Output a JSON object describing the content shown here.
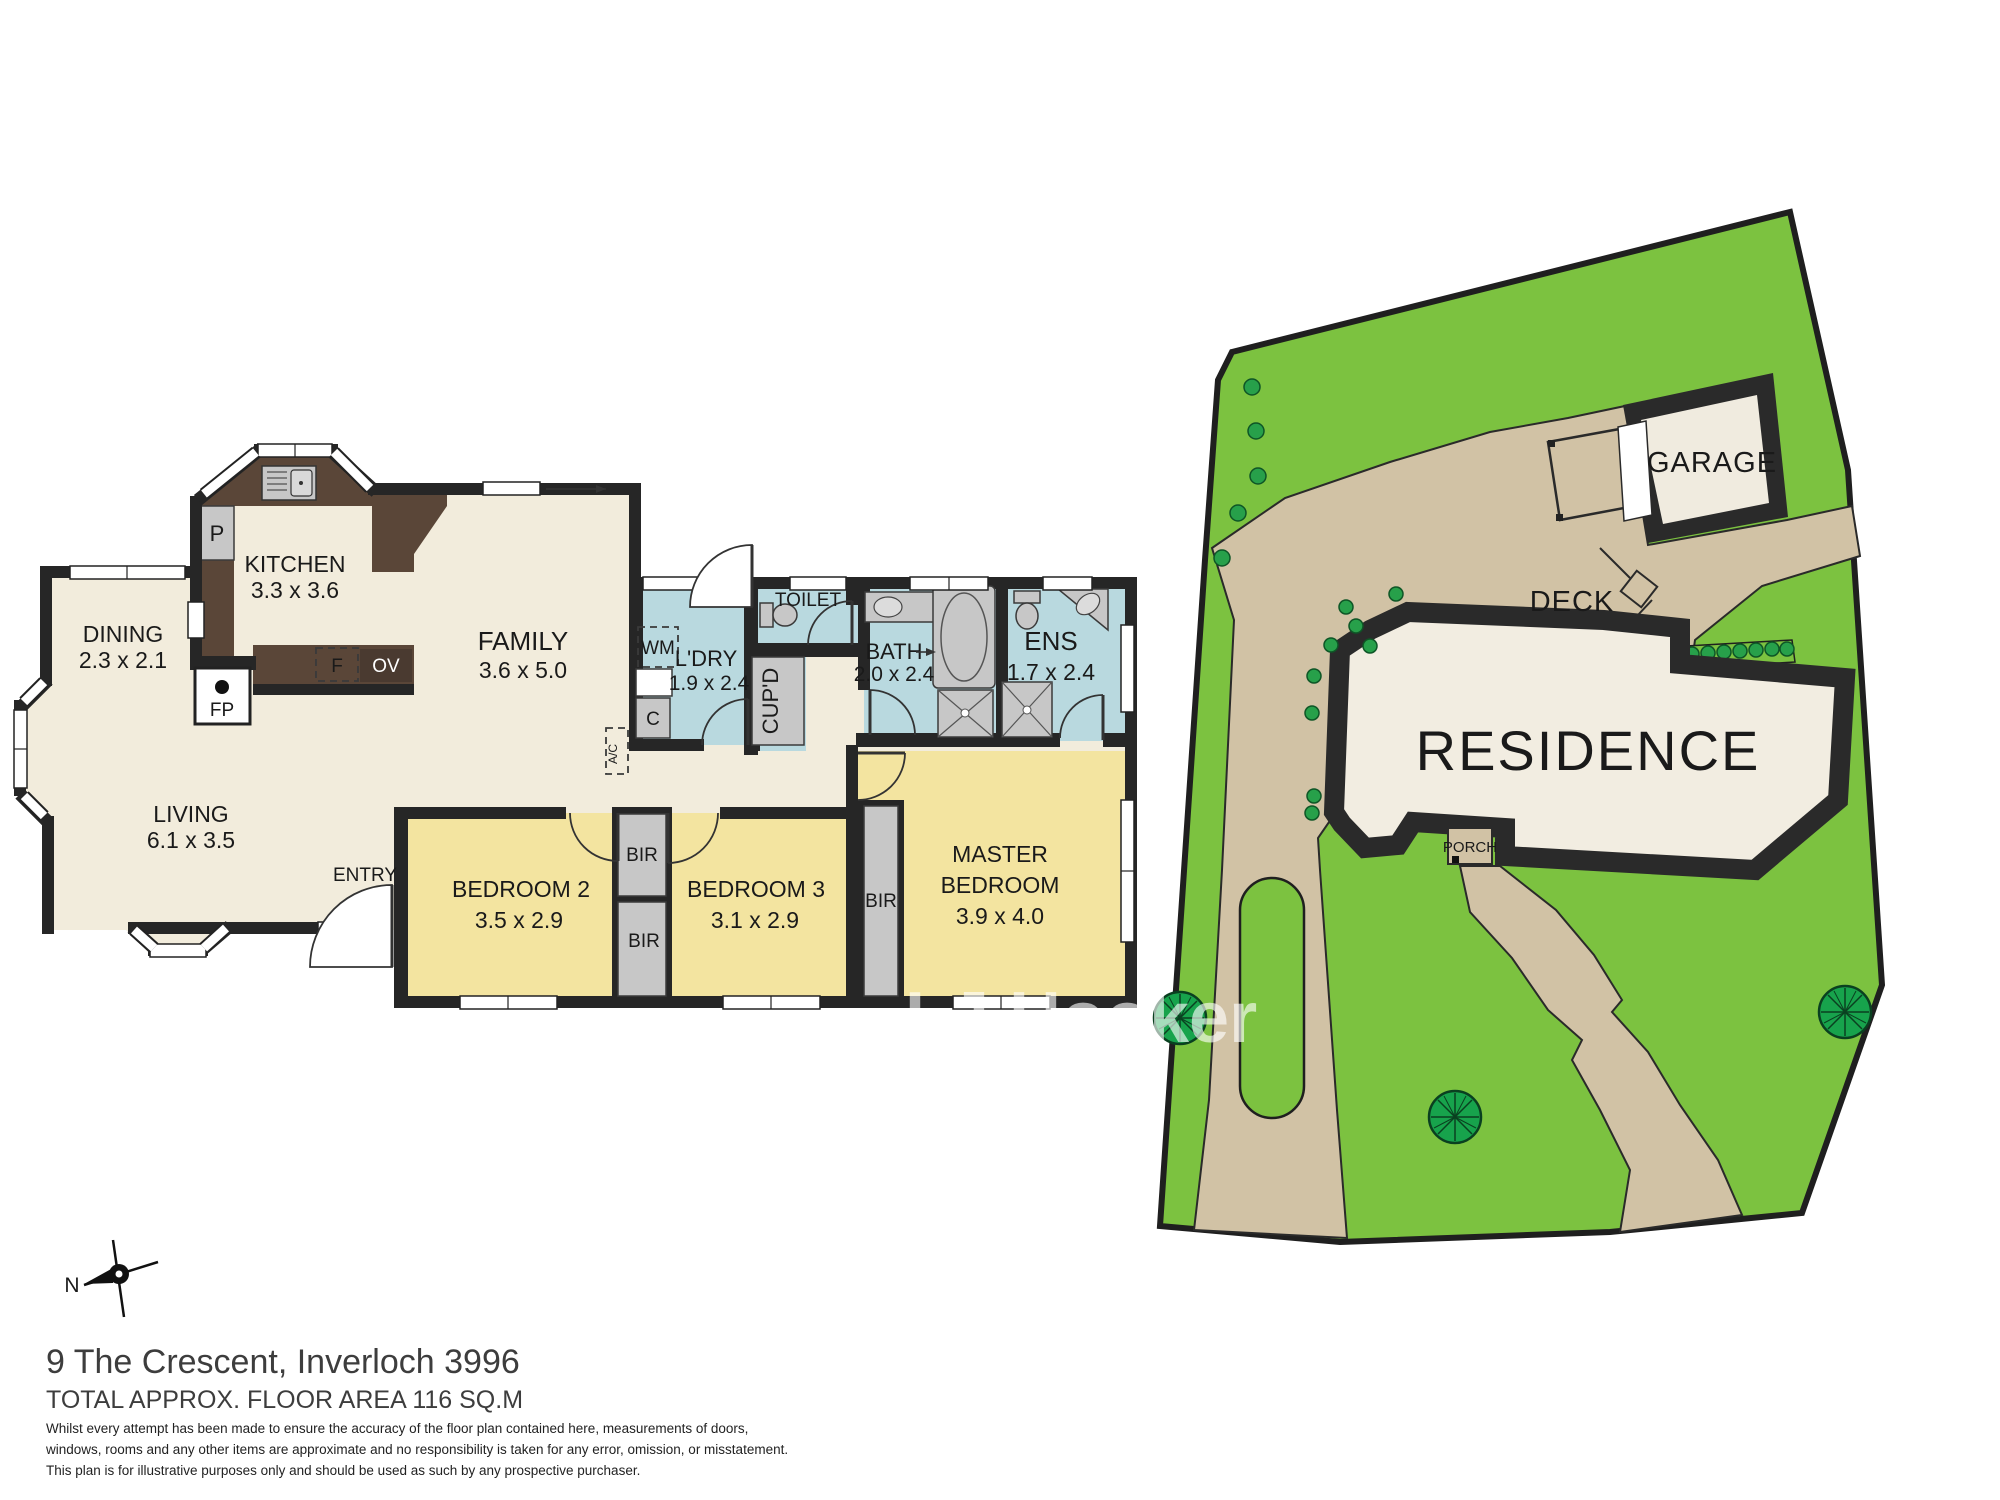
{
  "colors": {
    "wall": "#262626",
    "floor_beige": "#f2ecdc",
    "bedroom_yellow": "#f3e4a0",
    "wet_blue": "#b9d9df",
    "counter_brown": "#5a4638",
    "fixture_grey": "#c7c7c7",
    "site_green": "#7cc240",
    "paving_tan": "#d1c2a5",
    "tree_green": "#17a34c",
    "residence_cream": "#f2ede1"
  },
  "floor": {
    "rooms": {
      "dining": {
        "name": "DINING",
        "dims": "2.3 x 2.1"
      },
      "kitchen": {
        "name": "KITCHEN",
        "dims": "3.3 x 3.6"
      },
      "family": {
        "name": "FAMILY",
        "dims": "3.6 x 5.0"
      },
      "living": {
        "name": "LIVING",
        "dims": "6.1 x 3.5"
      },
      "entry": {
        "name": "ENTRY"
      },
      "bed2": {
        "name": "BEDROOM 2",
        "dims": "3.5 x 2.9"
      },
      "bed3": {
        "name": "BEDROOM 3",
        "dims": "3.1 x 2.9"
      },
      "master": {
        "l1": "MASTER",
        "l2": "BEDROOM",
        "dims": "3.9 x 4.0"
      },
      "ldry": {
        "name": "L'DRY",
        "dims": "1.9 x 2.4"
      },
      "bath": {
        "name": "BATH",
        "dims": "2.0 x 2.4"
      },
      "ens": {
        "name": "ENS",
        "dims": "1.7 x 2.4"
      },
      "toilet": {
        "name": "TOILET"
      }
    },
    "fixtures": {
      "pantry": "P",
      "fridge": "F",
      "oven": "OV",
      "fireplace": "FP",
      "washer": "WM",
      "trough": "C",
      "aircon": "A/C",
      "cupboard": "CUP'D",
      "robe": "BIR"
    }
  },
  "site": {
    "residence": "RESIDENCE",
    "deck": "DECK",
    "garage": "GARAGE",
    "porch": "PORCH"
  },
  "compass": {
    "north": "N"
  },
  "watermark": {
    "text": "LJ Hooker"
  },
  "footer": {
    "address": "9 The Crescent, Inverloch 3996",
    "area": "TOTAL APPROX. FLOOR AREA 116 SQ.M",
    "disclaimer1": "Whilst every attempt has been made to ensure the accuracy of the floor plan contained here, measurements of doors,",
    "disclaimer2": "windows, rooms and any other items are approximate and no responsibility is taken for any error, omission, or misstatement.",
    "disclaimer3": "This plan is for illustrative purposes only and should be used as such by any prospective purchaser."
  }
}
